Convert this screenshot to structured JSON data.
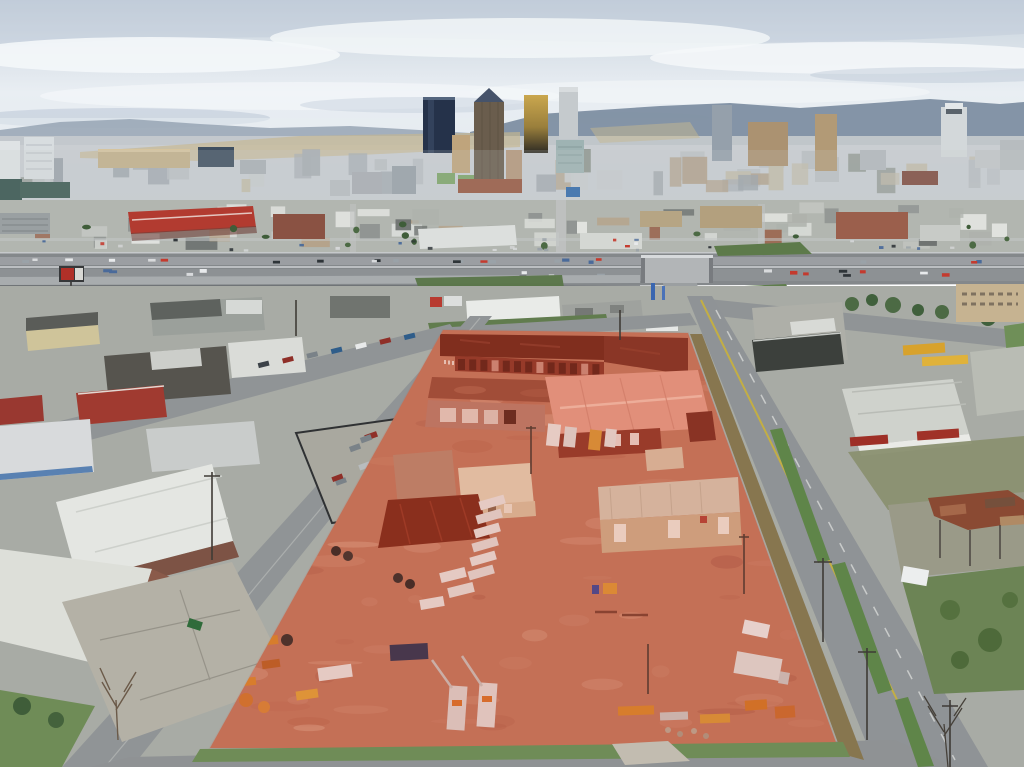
{
  "meta": {
    "type": "aerial-drone-photograph",
    "description": "Aerial drone photo of a large industrial property highlighted with a translucent red overlay in the foreground; downtown high-rise skyline on the horizon under a cloudy sky; an elevated interstate highway crosses the middle of the frame; surrounding low warehouse blocks, parking lots and streets; equipment, utility trucks and trailers in the red-tinted dirt yard.",
    "visible_text": "none"
  },
  "scene": {
    "regions": [
      {
        "name": "sky",
        "label": "overcast sky with blue patches"
      },
      {
        "name": "mountain-ridge",
        "label": "distant blue-gray ridge line"
      },
      {
        "name": "downtown-skyline",
        "label": "city high-rise skyline"
      },
      {
        "name": "midground-city",
        "label": "dense low-rise urban blocks"
      },
      {
        "name": "elevated-highway",
        "label": "interstate viaduct with traffic and overpass"
      },
      {
        "name": "highlighted-parcel",
        "label": "subject property with red overlay, warehouses and equipment yard"
      },
      {
        "name": "left-industrial-block",
        "label": "warehouses, fenced car lot, brick office"
      },
      {
        "name": "right-block",
        "label": "gravel lots, metal buildings, ruined shed, overgrown lot"
      },
      {
        "name": "streets",
        "label": "perimeter streets with yellow and white lane markings"
      }
    ]
  },
  "palette": {
    "sky1": "#c7d2dc",
    "sky2": "#e9eef3",
    "sky3": "#dfe6ec",
    "cloud": "#f4f7f9",
    "cloudshadow": "#b7c4d3",
    "ridge": "#7e8fa2",
    "ridge2": "#97a5b4",
    "haze": "#c7cbce",
    "hillside": "#c6b78f",
    "navy": "#25324a",
    "browntower": "#6a5d4d",
    "crown": "#46536a",
    "gold1": "#caa74e",
    "gold2": "#2e2b24",
    "graytower": "#c5cacd",
    "tealglass": "#9eb3b3",
    "white_b": "#dfe3e5",
    "tealdark": "#31504a",
    "arena": "#c3b08a",
    "brick": "#96563f",
    "gtow": "#95a0ab",
    "wtow": "#d3d8da",
    "rtan": "#b29a76",
    "midbase": "#b2b6b0",
    "redroof": "#b23b30",
    "brick2": "#8a5243",
    "hw": "#84888b",
    "hwlane": "#9da1a4",
    "bridge": "#b2b5b7",
    "ramp": "#a8acae",
    "grass": "#6f8c57",
    "grassdk": "#55713f",
    "tree": "#4c6a44",
    "emb": "#5d7a4a",
    "fg": "#a8aba5",
    "road": "#909496",
    "curb": "#c6c9c5",
    "yellowline": "#c9b23c",
    "dirt": "#c17a60",
    "overlay": "#d73e26",
    "maroon": "#6f2b1d",
    "maroon2": "#7c3526",
    "clere": "#8a3a2a",
    "flatred": "#97503c",
    "wallpink": "#b97f6d",
    "pinkroof": "#e3a08b",
    "pinkridge": "#f2c3b0",
    "darkredwall": "#8e3b2b",
    "tanwall": "#d9c2a2",
    "tanroof": "#e4d4b8",
    "tanwh": "#d5c9b4",
    "tanwhwall": "#cdb08d",
    "canopy": "#7c2d1c",
    "whitebldg": "#e9ebe8",
    "graybldg": "#9fa29e",
    "darkbldg": "#3c403c",
    "redb": "#a03a30",
    "rust": "#8a4a33",
    "rust2": "#a5684a",
    "truckwhite": "#e8e6e2",
    "orange": "#d88a2e",
    "yellowtruck": "#d8a22c",
    "bluebox": "#2c3654",
    "skyline_fill": [
      "#b9bec2",
      "#a7adb3",
      "#c7cbce",
      "#9aa1a8",
      "#b1a08a",
      "#8f968f",
      "#c2bba8"
    ],
    "midground_fill": [
      "#d9dcd8",
      "#c2c5c1",
      "#aeb2ac",
      "#8e9290",
      "#6d7270",
      "#b5a289",
      "#9c6b55",
      "#e2e4e0"
    ],
    "car_colors": [
      "#e8eaec",
      "#2e3438",
      "#9aa2a8",
      "#c43a2e",
      "#4a6a9a",
      "#d8dadc"
    ],
    "lot_car_colors": [
      "#e8eaea",
      "#b8bcbe",
      "#3c4248",
      "#7a8288",
      "#2f5d8a",
      "#8f2f28",
      "#4a9a96",
      "#d9dbda"
    ],
    "dirt_patches": [
      "#cf9177",
      "#b56a52",
      "#d9a288",
      "#a85f4b",
      "#c98a70",
      "#dcab90"
    ]
  }
}
